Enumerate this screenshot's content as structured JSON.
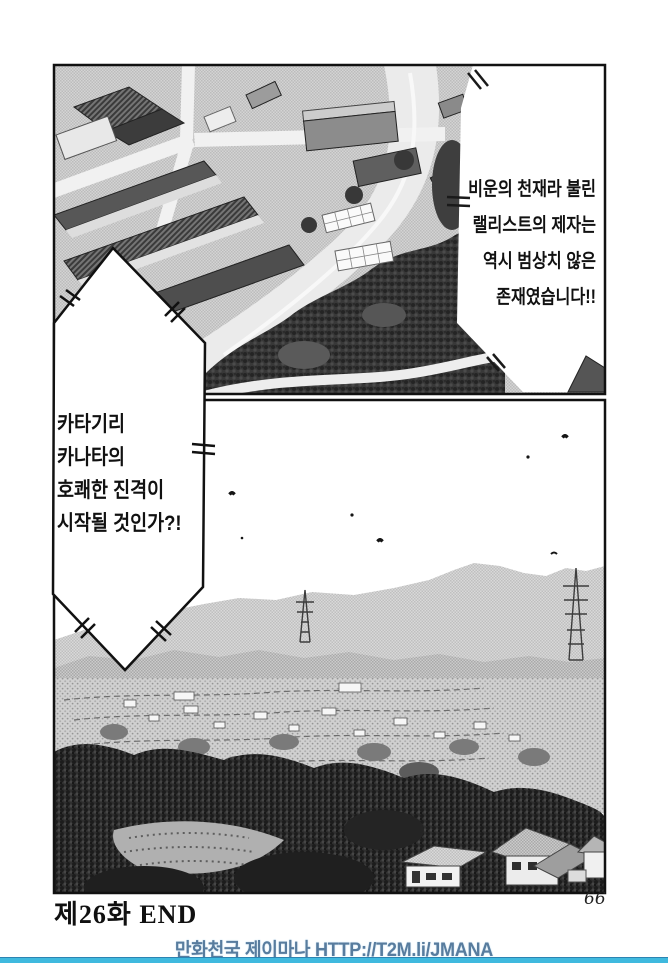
{
  "captions": {
    "narrator_right": {
      "lines": [
        "비운의 천재라 불린",
        "랠리스트의 제자는",
        "역시 범상치 않은",
        "존재였습니다!!"
      ]
    },
    "narrator_diamond": {
      "lines": [
        "카타기리",
        "카나타의",
        "호쾌한 진격이",
        "시작될 것인가?!"
      ]
    }
  },
  "page": {
    "chapter_end_label": "제26화 END",
    "page_number": "66"
  },
  "footer": {
    "site_and_url": "만화천국 제이마나 HTTP://T2M.li/JMANA",
    "text_color": "#587c9e",
    "rule_color": "#3fb9de"
  }
}
